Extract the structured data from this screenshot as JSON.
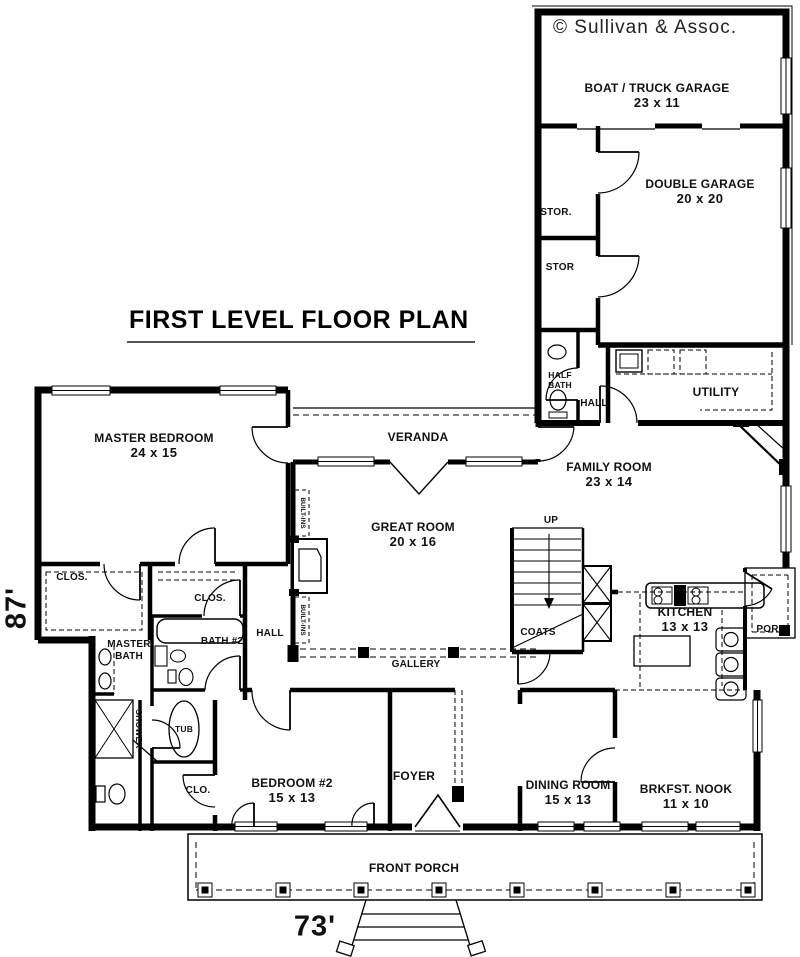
{
  "meta": {
    "title": "FIRST LEVEL FLOOR PLAN",
    "copyright": "© Sullivan & Assoc."
  },
  "dimensions": {
    "width": "73'",
    "height": "87'"
  },
  "rooms": [
    {
      "name": "BOAT / TRUCK GARAGE",
      "size": "23 x 11"
    },
    {
      "name": "DOUBLE GARAGE",
      "size": "20 x 20"
    },
    {
      "name": "MASTER BEDROOM",
      "size": "24 x 15"
    },
    {
      "name": "VERANDA",
      "size": ""
    },
    {
      "name": "GREAT ROOM",
      "size": "20 x 16"
    },
    {
      "name": "FAMILY ROOM",
      "size": "23 x 14"
    },
    {
      "name": "KITCHEN",
      "size": "13 x 13"
    },
    {
      "name": "BEDROOM #2",
      "size": "15 x 13"
    },
    {
      "name": "FOYER",
      "size": ""
    },
    {
      "name": "DINING ROOM",
      "size": "15 x 13"
    },
    {
      "name": "BRKFST. NOOK",
      "size": "11 x 10"
    },
    {
      "name": "FRONT PORCH",
      "size": ""
    },
    {
      "name": "UTILITY",
      "size": ""
    },
    {
      "name": "GALLERY",
      "size": ""
    }
  ],
  "areas": {
    "stor_upper": "STOR.",
    "stor_lower": "STOR",
    "half_bath": "HALF BATH",
    "hall_upper": "HALL",
    "hall_lower": "HALL",
    "closet_left": "CLOS.",
    "closet_walkin": "CLOS.",
    "master_bath": "MASTER BATH",
    "bath_2": "BATH #2",
    "coats": "COATS",
    "clo": "CLO.",
    "por": "POR.",
    "up": "UP",
    "tub": "TUB",
    "shower": "SHOWER",
    "built_ins_top": "BUILT-INS",
    "built_ins_bottom": "BUILT-INS"
  }
}
